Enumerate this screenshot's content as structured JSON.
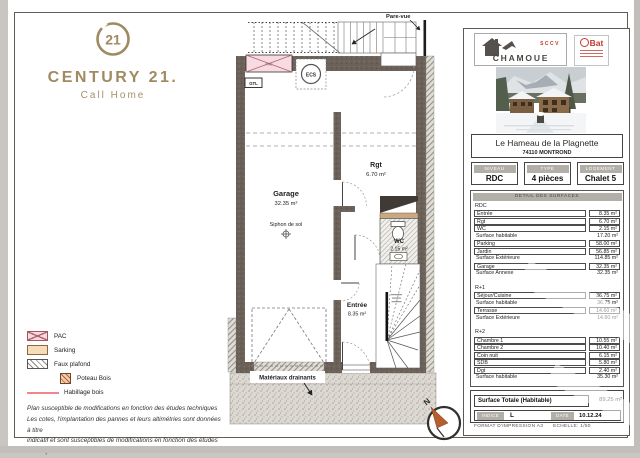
{
  "brand": {
    "seal_number": "21",
    "wordmark": "CENTURY 21.",
    "tagline": "Call Home"
  },
  "plan": {
    "labels": {
      "pare_vue": "Pare-vue",
      "pac": "PAC",
      "ecs": "ECS",
      "gtl": "GTL",
      "garage_name": "Garage",
      "garage_area": "32.35 m²",
      "siphon": "Siphon de sol",
      "rgt_name": "Rgt",
      "rgt_area": "6.70 m²",
      "wc_name": "WC",
      "wc_area": "2.15 m²",
      "entree_name": "Entrée",
      "entree_area": "8.35 m²",
      "materiaux": "Matériaux drainants",
      "north": "N"
    }
  },
  "legend": {
    "items": [
      {
        "key": "pac",
        "label": "PAC"
      },
      {
        "key": "sarking",
        "label": "Sarking"
      },
      {
        "key": "faux-plafond",
        "label": "Faux plafond"
      },
      {
        "key": "poteau-bois",
        "label": "Poteau Bois"
      },
      {
        "key": "habillage-bois",
        "label": "Habillage bois"
      }
    ],
    "notes": [
      "Plan susceptible de modifications en fonction des études techniques",
      "Les cotes, l'implantation des pannes et leurs altimétries sont données à titre",
      "indicatif et sont susceptibles de modifications en fonction des études techniques"
    ]
  },
  "panel": {
    "logos": {
      "sccv": "SCCV",
      "chamoue": "CHAMOUE",
      "bat": "Bat"
    },
    "title": "Le Hameau de la Plagnette",
    "subtitle": "74110 MONTROND",
    "meta": [
      {
        "label": "NIVEAU",
        "value": "RDC"
      },
      {
        "label": "TYPE",
        "value": "4 pièces"
      },
      {
        "label": "LOGEMENT",
        "value": "Chalet 5"
      }
    ],
    "detail_header": "DETAIL DES SURFACES",
    "sections": [
      {
        "name": "RDC",
        "rows": [
          {
            "label": "Entrée",
            "value": "8.35 m²",
            "boxed": true
          },
          {
            "label": "Rgt",
            "value": "6.70 m²",
            "boxed": true
          },
          {
            "label": "WC",
            "value": "2.15 m²",
            "boxed": true
          },
          {
            "label": "Surface habitable",
            "value": "17.20 m²",
            "boxed": false
          },
          {
            "label": "Parking",
            "value": "58.00 m²",
            "boxed": true
          },
          {
            "label": "Jardin",
            "value": "56.85 m²",
            "boxed": true
          },
          {
            "label": "Surface Extérieure",
            "value": "114.85 m²",
            "boxed": false
          },
          {
            "label": "Garage",
            "value": "32.35 m²",
            "boxed": true
          },
          {
            "label": "Surface Annexe",
            "value": "32.35 m²",
            "boxed": false
          }
        ]
      },
      {
        "name": "R+1",
        "rows": [
          {
            "label": "Séjour/Cuisine",
            "value": "36.75 m²",
            "boxed": true
          },
          {
            "label": "Surface habitable",
            "value": "36.75 m²",
            "boxed": false
          },
          {
            "label": "Terrasse",
            "value": "14.60 m²",
            "boxed": true
          },
          {
            "label": "Surface Extérieure",
            "value": "14.60 m²",
            "boxed": false
          }
        ]
      },
      {
        "name": "R+2",
        "rows": [
          {
            "label": "Chambre 1",
            "value": "10.55 m²",
            "boxed": true
          },
          {
            "label": "Chambre 2",
            "value": "10.40 m²",
            "boxed": true
          },
          {
            "label": "Coin nuit",
            "value": "6.15 m²",
            "boxed": true
          },
          {
            "label": "SDB",
            "value": "5.80 m²",
            "boxed": true
          },
          {
            "label": "Dgt",
            "value": "2.40 m²",
            "boxed": true
          },
          {
            "label": "Surface habitable",
            "value": "35.30 m²",
            "boxed": false
          }
        ]
      }
    ],
    "total": {
      "label": "Surface Totale (Habitable)",
      "value": "89.25 m²"
    },
    "indice": {
      "label": "INDICE",
      "value": "L"
    },
    "date": {
      "label": "DATE",
      "value": "10.12.24"
    },
    "footer": {
      "format": "FORMAT D'IMPRESSION A3",
      "scale": "ECHELLE: 1/50"
    }
  },
  "colors": {
    "brand_gold": "#9f8a61",
    "wall": "#6b6159",
    "pac_pink": "#f8dbe2",
    "sarking_tan": "#f6dcb8",
    "habillage_red": "#ee868b",
    "chip_grey": "#b2aea8",
    "logo_red": "#c0392b",
    "compass_orange": "#b65f2c"
  }
}
